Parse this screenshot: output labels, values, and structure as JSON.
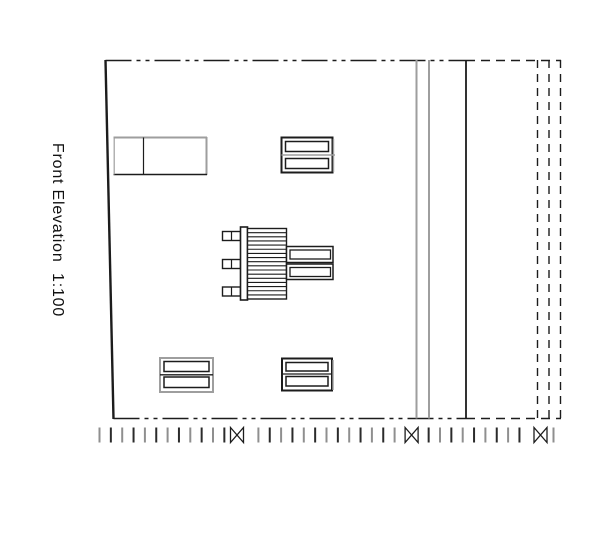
{
  "title": "Front Elevation  1:100",
  "colors": {
    "ink": "#1c1c1c",
    "gray": "#9e9e9e",
    "bg": "#ffffff"
  },
  "drawing": {
    "primitives": [
      {
        "type": "line",
        "name": "left-wall-edge",
        "x1": 105.5,
        "y1": 60,
        "x2": 113.5,
        "y2": 419,
        "w": 2.4
      },
      {
        "type": "line",
        "name": "top-edge-centerline",
        "x1": 105.5,
        "y1": 60.5,
        "x2": 466,
        "y2": 60.5,
        "w": 1.6,
        "dash": "26 5 4 5 4 5"
      },
      {
        "type": "line",
        "name": "top-edge-dashed-extension",
        "x1": 466,
        "y1": 60.5,
        "x2": 561,
        "y2": 60.5,
        "w": 1.6,
        "dash": "9 6"
      },
      {
        "type": "line",
        "name": "bottom-edge-centerline",
        "x1": 113.5,
        "y1": 418.5,
        "x2": 466,
        "y2": 418.5,
        "w": 1.6,
        "dash": "26 5 4 5 4 5"
      },
      {
        "type": "line",
        "name": "bottom-edge-dashed-extension",
        "x1": 466,
        "y1": 418.5,
        "x2": 561,
        "y2": 418.5,
        "w": 1.6,
        "dash": "9 6"
      },
      {
        "type": "line",
        "name": "wall-joint-gray-1",
        "x1": 416.5,
        "y1": 60,
        "x2": 416.5,
        "y2": 418.5,
        "w": 2,
        "color": "gray"
      },
      {
        "type": "line",
        "name": "wall-joint-gray-2",
        "x1": 429,
        "y1": 60,
        "x2": 429,
        "y2": 418.5,
        "w": 2,
        "color": "gray"
      },
      {
        "type": "line",
        "name": "right-wall-edge",
        "x1": 466,
        "y1": 60,
        "x2": 466,
        "y2": 418.5,
        "w": 1.8
      },
      {
        "type": "line",
        "name": "hidden-edge-1",
        "x1": 537.5,
        "y1": 60,
        "x2": 537.5,
        "y2": 418.5,
        "w": 1.4,
        "dash": "8 6"
      },
      {
        "type": "line",
        "name": "hidden-edge-2",
        "x1": 549,
        "y1": 60,
        "x2": 549,
        "y2": 418.5,
        "w": 1.4,
        "dash": "8 6"
      },
      {
        "type": "line",
        "name": "hidden-edge-3",
        "x1": 560.5,
        "y1": 60,
        "x2": 560.5,
        "y2": 418.5,
        "w": 1.4,
        "dash": "8 6"
      },
      {
        "type": "line",
        "name": "cabinet-top-edge",
        "x1": 113.5,
        "y1": 137.5,
        "x2": 207,
        "y2": 137.5,
        "w": 2,
        "color": "gray"
      },
      {
        "type": "line",
        "name": "cabinet-right-edge",
        "x1": 206.5,
        "y1": 137,
        "x2": 206.5,
        "y2": 175,
        "w": 2,
        "color": "gray"
      },
      {
        "type": "line",
        "name": "cabinet-bottom-edge",
        "x1": 113.5,
        "y1": 174.5,
        "x2": 207,
        "y2": 174.5,
        "w": 1.4
      },
      {
        "type": "line",
        "name": "cabinet-left-edge",
        "x1": 114.2,
        "y1": 137.5,
        "x2": 114.2,
        "y2": 174.5,
        "w": 1.2,
        "color": "gray"
      },
      {
        "type": "line",
        "name": "cabinet-divider",
        "x1": 143.5,
        "y1": 137.5,
        "x2": 143.5,
        "y2": 174.5,
        "w": 1.2
      },
      {
        "type": "rect",
        "name": "window-top-frame",
        "x": 281.5,
        "y": 137.5,
        "w": 51,
        "h": 35,
        "sw": 2
      },
      {
        "type": "line",
        "name": "window-top-shadow",
        "x1": 333.5,
        "y1": 139,
        "x2": 333.5,
        "y2": 172,
        "w": 1.4,
        "color": "gray"
      },
      {
        "type": "line",
        "name": "window-top-mid-rail",
        "x1": 281.5,
        "y1": 155,
        "x2": 335,
        "y2": 155,
        "w": 1.5,
        "color": "gray"
      },
      {
        "type": "rect",
        "name": "window-top-pane-upper",
        "x": 285.5,
        "y": 141.5,
        "w": 43,
        "h": 10,
        "sw": 1.5
      },
      {
        "type": "rect",
        "name": "window-top-pane-lower",
        "x": 285.5,
        "y": 158.5,
        "w": 43,
        "h": 10,
        "sw": 1.5
      },
      {
        "type": "rect",
        "name": "bracket-top",
        "x": 222.5,
        "y": 231.5,
        "w": 18,
        "h": 9,
        "sw": 1.4
      },
      {
        "type": "rect",
        "name": "bracket-middle",
        "x": 222.5,
        "y": 259.5,
        "w": 18,
        "h": 9,
        "sw": 1.4
      },
      {
        "type": "rect",
        "name": "bracket-bottom",
        "x": 222.5,
        "y": 287,
        "w": 18,
        "h": 9,
        "sw": 1.4
      },
      {
        "type": "line",
        "name": "bracket-top-divider",
        "x1": 231.5,
        "y1": 231.5,
        "x2": 231.5,
        "y2": 240.5,
        "w": 1.2
      },
      {
        "type": "line",
        "name": "bracket-middle-divider",
        "x1": 231.5,
        "y1": 259.5,
        "x2": 231.5,
        "y2": 268.5,
        "w": 1.2
      },
      {
        "type": "line",
        "name": "bracket-bottom-divider",
        "x1": 231.5,
        "y1": 287,
        "x2": 231.5,
        "y2": 296,
        "w": 1.2
      },
      {
        "type": "rect",
        "name": "flue-post",
        "x": 240.5,
        "y": 227,
        "w": 7,
        "h": 73,
        "sw": 1.6
      },
      {
        "type": "hatch",
        "name": "louvre-stack",
        "x": 247.5,
        "y": 228.5,
        "w": 39,
        "h": 70.5,
        "sw": 1.4,
        "lw": 1.1,
        "spacing": 4.15
      },
      {
        "type": "rect",
        "name": "duct-upper-outer",
        "x": 286.5,
        "y": 246.5,
        "w": 46.5,
        "h": 16,
        "sw": 1.5
      },
      {
        "type": "rect",
        "name": "duct-upper-inner",
        "x": 290,
        "y": 250,
        "w": 40.5,
        "h": 9,
        "sw": 1.3
      },
      {
        "type": "rect",
        "name": "duct-lower-outer",
        "x": 286.5,
        "y": 264,
        "w": 46.5,
        "h": 15.5,
        "sw": 1.5
      },
      {
        "type": "rect",
        "name": "duct-lower-inner",
        "x": 290,
        "y": 267.5,
        "w": 40.5,
        "h": 9,
        "sw": 1.3
      },
      {
        "type": "rect",
        "name": "window-bottom-left-frame",
        "x": 160,
        "y": 358,
        "w": 53,
        "h": 34,
        "sw": 2,
        "color": "gray"
      },
      {
        "type": "line",
        "name": "window-bottom-left-mid-rail",
        "x1": 160,
        "y1": 374.8,
        "x2": 213,
        "y2": 374.8,
        "w": 1.3
      },
      {
        "type": "rect",
        "name": "window-bottom-left-pane-upper",
        "x": 164,
        "y": 361.5,
        "w": 45,
        "h": 10,
        "sw": 1.5
      },
      {
        "type": "rect",
        "name": "window-bottom-left-pane-lower",
        "x": 164,
        "y": 377,
        "w": 45,
        "h": 10.5,
        "sw": 1.5
      },
      {
        "type": "rect",
        "name": "window-bottom-right-frame",
        "x": 282,
        "y": 358.5,
        "w": 50,
        "h": 32,
        "sw": 2
      },
      {
        "type": "line",
        "name": "window-bottom-right-shadow",
        "x1": 333,
        "y1": 360,
        "x2": 333,
        "y2": 390,
        "w": 1.4,
        "color": "gray"
      },
      {
        "type": "line",
        "name": "window-bottom-right-mid-rail",
        "x1": 282,
        "y1": 374,
        "x2": 332,
        "y2": 374,
        "w": 1.3
      },
      {
        "type": "rect",
        "name": "window-bottom-right-pane-upper",
        "x": 286,
        "y": 362.5,
        "w": 42,
        "h": 8.5,
        "sw": 1.5
      },
      {
        "type": "rect",
        "name": "window-bottom-right-pane-lower",
        "x": 286,
        "y": 376.5,
        "w": 42,
        "h": 9.5,
        "sw": 1.5
      }
    ],
    "fence": {
      "start": 99.5,
      "end": 554,
      "spacing": 11.35,
      "y": 427.5,
      "h": 15,
      "w": 2,
      "colors": [
        "#8f8f8f",
        "#2b2b2b"
      ],
      "markers": [
        237,
        411.6,
        540.5
      ],
      "marker_halfwidth": 6.5,
      "marker_stroke": 1.3,
      "skip_radius": 11
    }
  }
}
